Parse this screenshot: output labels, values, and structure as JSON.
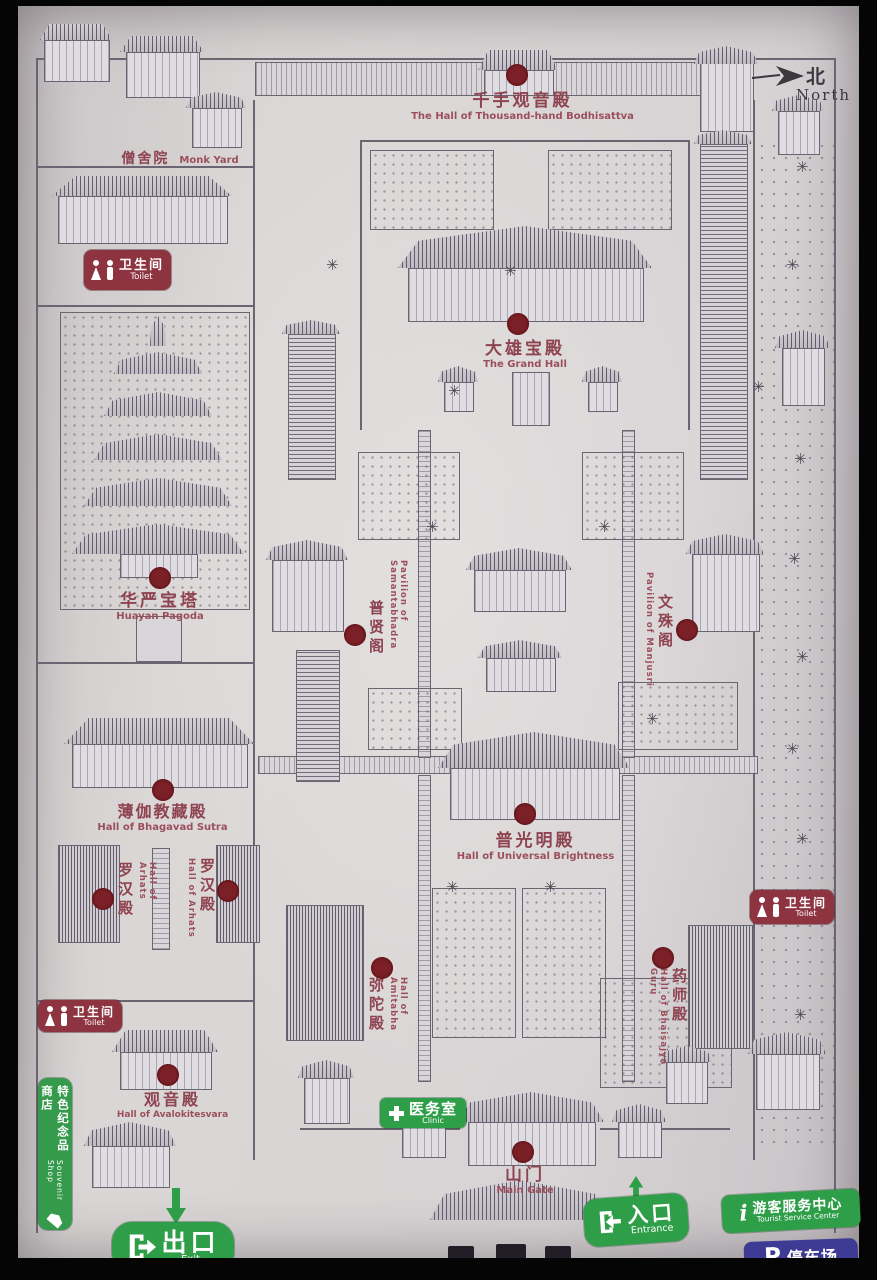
{
  "palette": {
    "paper": "#d7d3d4",
    "ink": "#5d5864",
    "label_red": "#8e4350",
    "dot_red": "#7b2027",
    "toilet_red": "#8e3340",
    "green": "#2f9e49",
    "parking_blue": "#3e3b94"
  },
  "compass": {
    "zh": "北",
    "en": "North"
  },
  "pois": {
    "thousand_hand": {
      "zh": "千手观音殿",
      "en": "The Hall of Thousand-hand Bodhisattva"
    },
    "monk_yard": {
      "zh": "僧舍院",
      "en": "Monk Yard"
    },
    "grand_hall": {
      "zh": "大雄宝殿",
      "en": "The Grand Hall"
    },
    "huayan_pagoda": {
      "zh": "华严宝塔",
      "en": "Huayan Pagoda"
    },
    "samantabhadra": {
      "zh": "普贤阁",
      "en": "Pavilion of Samantabhadra"
    },
    "manjusri": {
      "zh": "文殊阁",
      "en": "Pavilion of Manjusri"
    },
    "bhagavad_sutra": {
      "zh": "薄伽教藏殿",
      "en": "Hall of Bhagavad Sutra"
    },
    "arhats": {
      "zh": "罗汉殿",
      "en": "Hall of Arhats"
    },
    "universal_brightness": {
      "zh": "普光明殿",
      "en": "Hall of Universal Brightness"
    },
    "amitabha": {
      "zh": "弥陀殿",
      "en": "Hall of Amitabha"
    },
    "bhaisajya_guru": {
      "zh": "药师殿",
      "en": "Hall of Bhaisajya Guru"
    },
    "avalokitesvara": {
      "zh": "观音殿",
      "en": "Hall of Avalokitesvara"
    },
    "main_gate": {
      "zh": "山门",
      "en": "Main Gate"
    }
  },
  "facilities": {
    "toilet": {
      "zh": "卫生间",
      "en": "Toilet"
    },
    "clinic": {
      "zh": "医务室",
      "en": "Clinic"
    },
    "souvenir": {
      "zh": "特色纪念品商店",
      "en": "Souvenir Shop"
    },
    "exit": {
      "zh": "出口",
      "en": "Exit"
    },
    "entrance": {
      "zh": "入口",
      "en": "Entrance"
    },
    "tourist_center": {
      "zh": "游客服务中心",
      "en": "Tourist Service Center",
      "symbol": "i"
    },
    "parking": {
      "zh": "停车场",
      "symbol": "P"
    }
  }
}
